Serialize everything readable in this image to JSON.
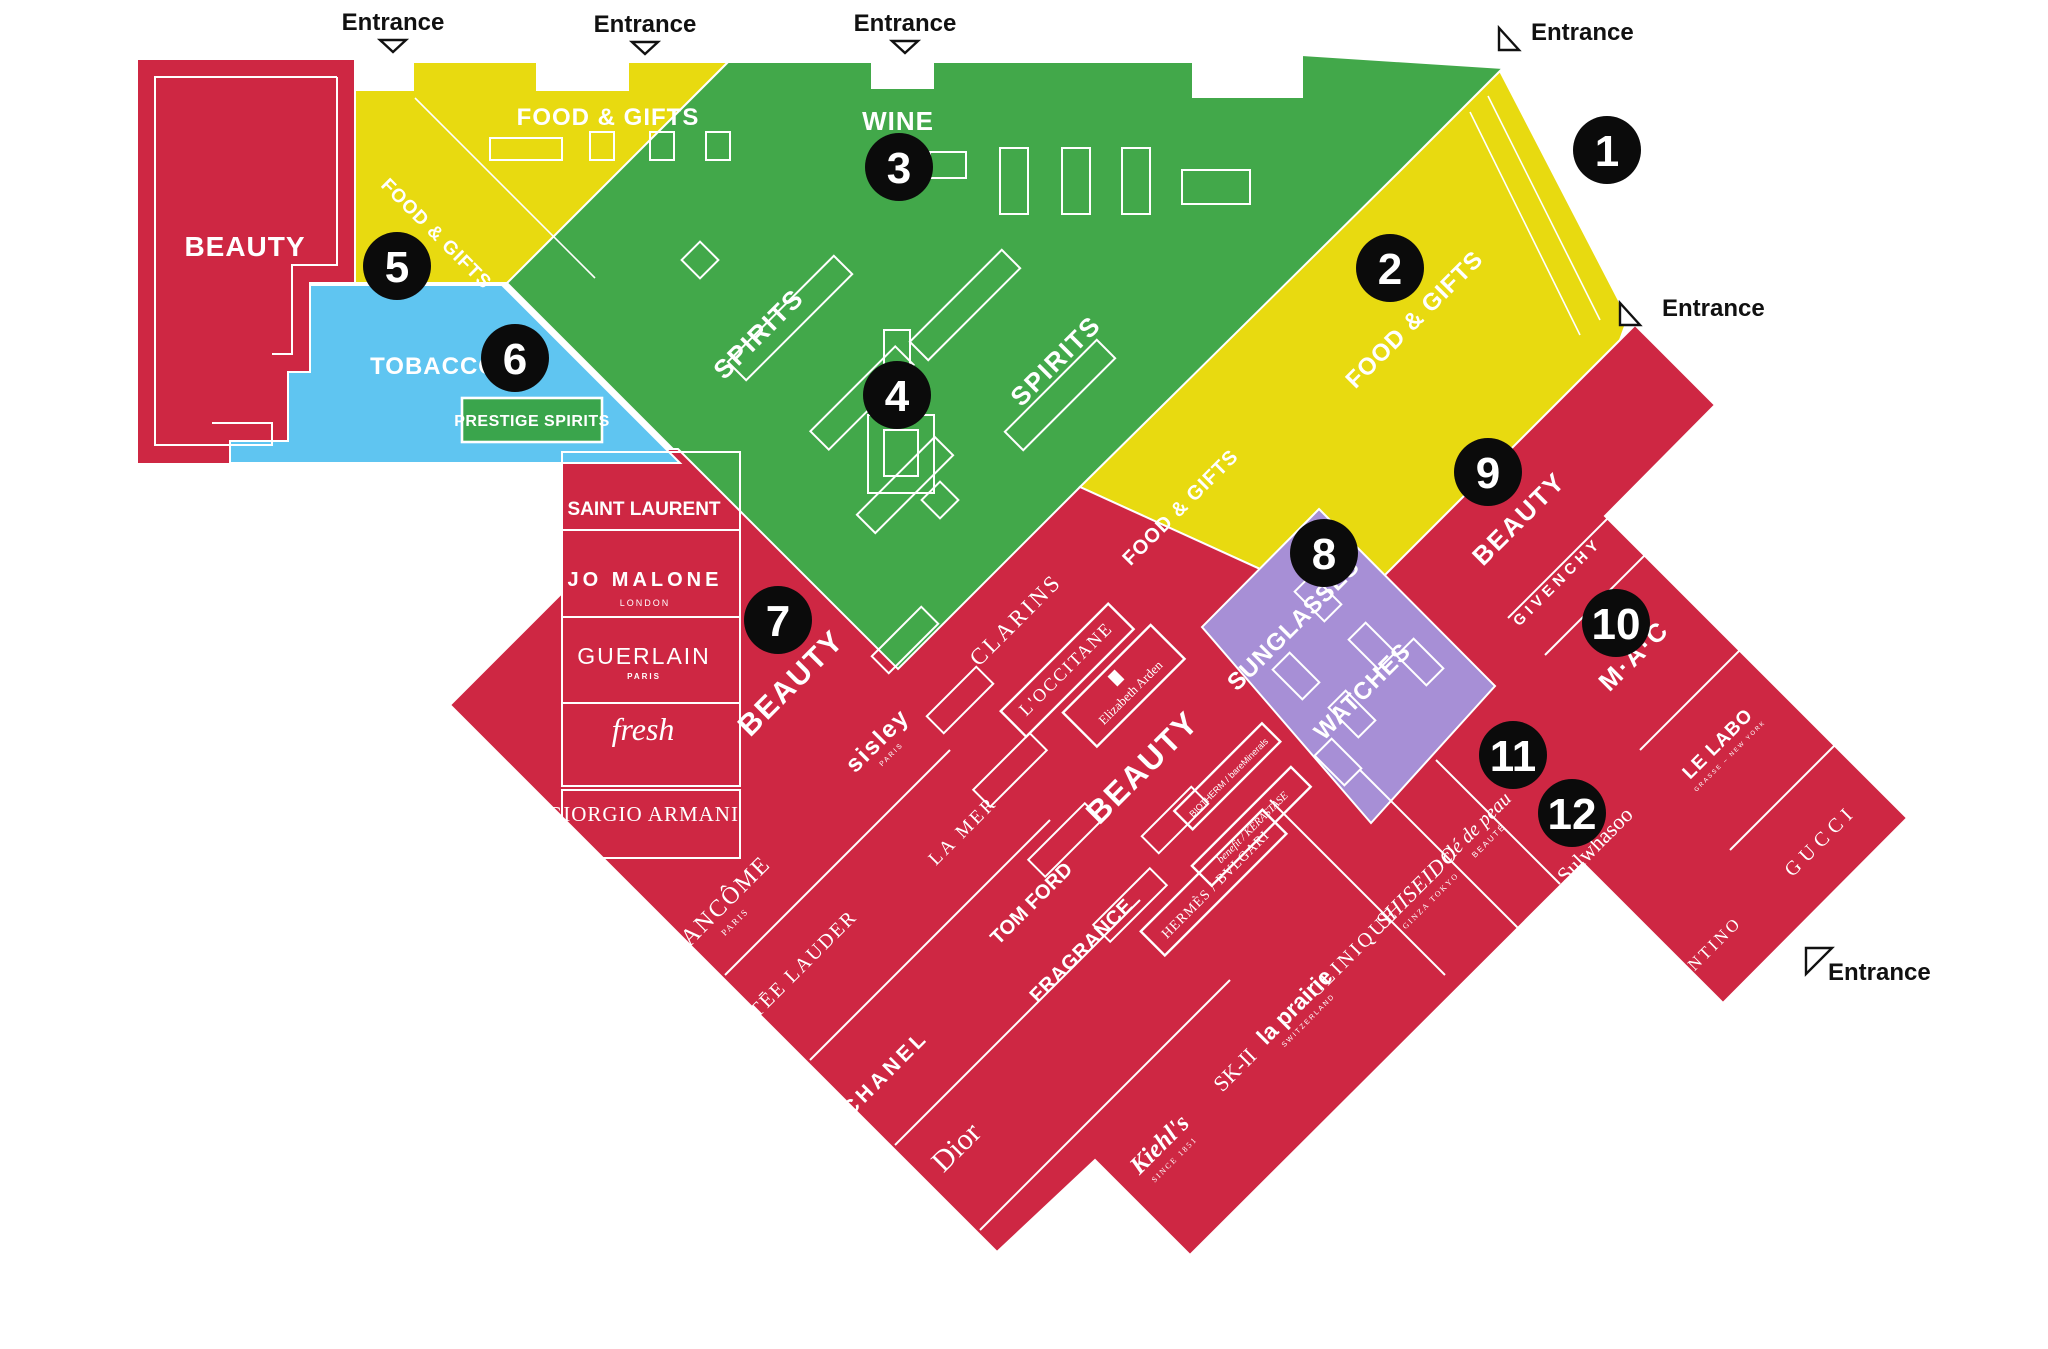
{
  "colors": {
    "beauty_red": "#ce2743",
    "food_gifts_yellow": "#e8da10",
    "wine_spirits_green": "#42a84a",
    "tobacco_blue": "#5fc5f1",
    "sunglasses_purple": "#a78fd6",
    "marker_black": "#0b0b0b",
    "prestige_green": "#3aa54c",
    "background": "#ffffff"
  },
  "legend_markers": [
    {
      "n": "1",
      "t": "translate(1607,150)"
    },
    {
      "n": "2",
      "t": "translate(1390,268)"
    },
    {
      "n": "3",
      "t": "translate(899,167)"
    },
    {
      "n": "4",
      "t": "translate(897,395)"
    },
    {
      "n": "5",
      "t": "translate(397,266)"
    },
    {
      "n": "6",
      "t": "translate(515,358)"
    },
    {
      "n": "7",
      "t": "translate(778,620)"
    },
    {
      "n": "8",
      "t": "translate(1324,553)"
    },
    {
      "n": "9",
      "t": "translate(1488,472)"
    },
    {
      "n": "10",
      "t": "translate(1616,623)"
    },
    {
      "n": "11",
      "t": "translate(1513,755)"
    },
    {
      "n": "12",
      "t": "translate(1572,813)"
    }
  ],
  "entrances": [
    {
      "label": "Entrance",
      "t": "translate(393,30)",
      "arrow": "down"
    },
    {
      "label": "Entrance",
      "t": "translate(645,32)",
      "arrow": "down"
    },
    {
      "label": "Entrance",
      "t": "translate(905,31)",
      "arrow": "down"
    },
    {
      "label": "Entrance",
      "t": "translate(1499,18)",
      "arrow": "corner"
    },
    {
      "label": "Entrance",
      "t": "translate(1620,298)",
      "arrow": "corner"
    },
    {
      "label": "Entrance",
      "t": "translate(1806,942)",
      "arrow": "corner-up"
    }
  ],
  "zone_labels": [
    {
      "text": "BEAUTY",
      "t": "translate(245,256)"
    },
    {
      "text": "FOOD & GIFTS",
      "t": "translate(608,125)"
    },
    {
      "text": "FOOD & GIFTS",
      "t": "translate(432,238) rotate(45)"
    },
    {
      "text": "TOBACCO",
      "t": "translate(434,374)"
    },
    {
      "text": "WINE",
      "t": "translate(898,130)"
    },
    {
      "text": "SPIRITS",
      "t": "translate(765,340) rotate(-45)"
    },
    {
      "text": "SPIRITS",
      "t": "translate(1062,367) rotate(-45)"
    },
    {
      "text": "FOOD & GIFTS",
      "t": "translate(1420,325) rotate(-45)"
    },
    {
      "text": "FOOD & GIFTS",
      "t": "translate(1185,512) rotate(-45)"
    },
    {
      "text": "SUNGLASSES",
      "t": "translate(1299,630) rotate(-45)"
    },
    {
      "text": "WATCHES",
      "t": "translate(1368,697) rotate(-45)"
    },
    {
      "text": "BEAUTY",
      "t": "translate(798,690) rotate(-45)"
    },
    {
      "text": "BEAUTY",
      "t": "translate(1150,775) rotate(-45)"
    },
    {
      "text": "BEAUTY",
      "t": "translate(1525,525) rotate(-45)"
    }
  ],
  "prestige_box": {
    "text": "PRESTIGE SPIRITS"
  },
  "brands": [
    {
      "name": "SAINT LAURENT",
      "t": "translate(644,515)"
    },
    {
      "name": "JO MALONE",
      "sub": "LONDON",
      "t": "translate(645,586)"
    },
    {
      "name": "GUERLAIN",
      "sub": "PARIS",
      "t": "translate(644,664)"
    },
    {
      "name": "fresh",
      "t": "translate(643,740)"
    },
    {
      "name": "GIORGIO ARMANI",
      "t": "translate(643,821)"
    },
    {
      "name": "LANCÔME",
      "sub": "PARIS",
      "t": "translate(725,912) rotate(-45)"
    },
    {
      "name": "ESTĒE LAUDER",
      "t": "translate(798,978) rotate(-45)"
    },
    {
      "name": "CHANEL",
      "t": "translate(890,1078) rotate(-45)"
    },
    {
      "name": "Dior",
      "t": "translate(963,1154) rotate(-45)"
    },
    {
      "name": "sisley",
      "sub": "PARIS",
      "t": "translate(883,746) rotate(-45)"
    },
    {
      "name": "LA MER",
      "t": "translate(967,835) rotate(-45)"
    },
    {
      "name": "CLARINS",
      "t": "translate(1021,625) rotate(-45)"
    },
    {
      "name": "L'OCCITANE",
      "t": "translate(1070,673) rotate(-45)"
    },
    {
      "name": "Elizabeth Arden",
      "t": "translate(1128,690) rotate(-45)"
    },
    {
      "name": "TOM FORD",
      "t": "translate(1036,908) rotate(-45)"
    },
    {
      "name": "FRAGRANCE",
      "t": "translate(1086,955) rotate(-45)"
    },
    {
      "name": "HERMÈS / BVLGARI",
      "t": "translate(1215,884) rotate(-45)"
    },
    {
      "name": "BIOTHERM / bareMinerals",
      "t": "translate(1228,777) rotate(-45)"
    },
    {
      "name": "benefit / KÉRASTASE",
      "t": "translate(1252,827) rotate(-45)"
    },
    {
      "name": "la prairie",
      "sub": "SWITZERLAND",
      "t": "translate(1300,1012) rotate(-45)"
    },
    {
      "name": "SK-II",
      "t": "translate(1240,1075) rotate(-45)"
    },
    {
      "name": "Kiehl's",
      "sub": "SINCE 1851",
      "t": "translate(1165,1150) rotate(-45)"
    },
    {
      "name": "CLINIQUE",
      "t": "translate(1358,956) rotate(-45)"
    },
    {
      "name": "SHISEIDO",
      "sub": "GINZA TOKYO",
      "t": "translate(1422,892) rotate(-45)"
    },
    {
      "name": "clé de peau",
      "sub": "BEAUTÉ",
      "t": "translate(1480,832) rotate(-45)"
    },
    {
      "name": "Sulwhasoo",
      "t": "translate(1600,850) rotate(-45)"
    },
    {
      "name": "VALENTINO",
      "t": "translate(1699,967) rotate(-45)"
    },
    {
      "name": "GIVENCHY",
      "t": "translate(1561,585) rotate(-45)"
    },
    {
      "name": "M·A·C",
      "t": "translate(1640,662) rotate(-45)"
    },
    {
      "name": "LE LABO",
      "sub": "GRASSE – NEW YORK",
      "t": "translate(1722,748) rotate(-45)"
    },
    {
      "name": "GUCCI",
      "t": "translate(1825,845) rotate(-45)"
    }
  ]
}
